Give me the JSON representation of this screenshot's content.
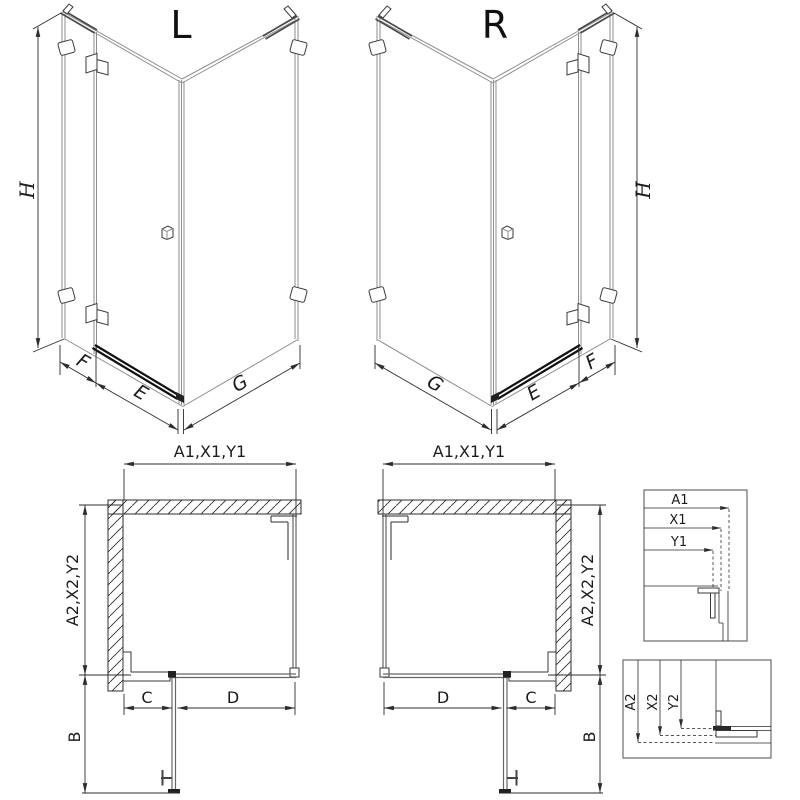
{
  "labels": {
    "left_variant": "L",
    "right_variant": "R",
    "height": "H",
    "return_panel": "F",
    "door": "E",
    "side_panel": "G",
    "width_combo": "A1,X1,Y1",
    "depth_combo": "A2,X2,Y2",
    "fixed_segment": "C",
    "door_segment": "D",
    "swing": "B"
  },
  "detail_width_labels": [
    "A1",
    "X1",
    "Y1"
  ],
  "detail_depth_labels": [
    "A2",
    "X2",
    "Y2"
  ],
  "colors": {
    "background": "#ffffff",
    "line_dark": "#2d2d2d",
    "line_gray": "#8d8d8d",
    "profile_black": "#111111"
  }
}
